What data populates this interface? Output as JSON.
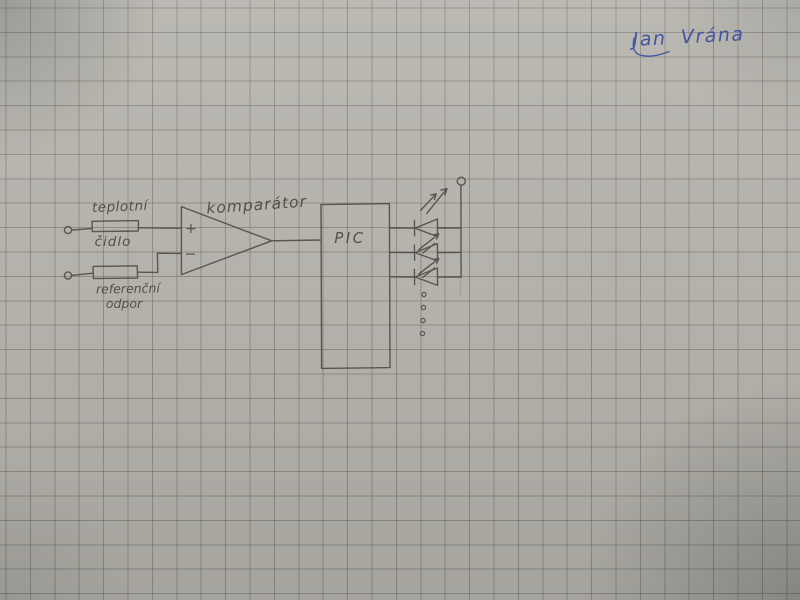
{
  "signature": {
    "name": "Jan Vrána",
    "ink_color": "#3c4ca3"
  },
  "schematic": {
    "labels": {
      "sensor_line1": "teplotní",
      "sensor_line2": "čidlo",
      "reference_line1": "referenční",
      "reference_line2": "odpor",
      "comparator": "komparátor",
      "mcu": "PIC",
      "plus_input": "+",
      "minus_input": "−"
    },
    "colors": {
      "pencil": "#4e4a44",
      "paper": "#b6b4ad",
      "grid_line": "#8f8d86"
    }
  }
}
